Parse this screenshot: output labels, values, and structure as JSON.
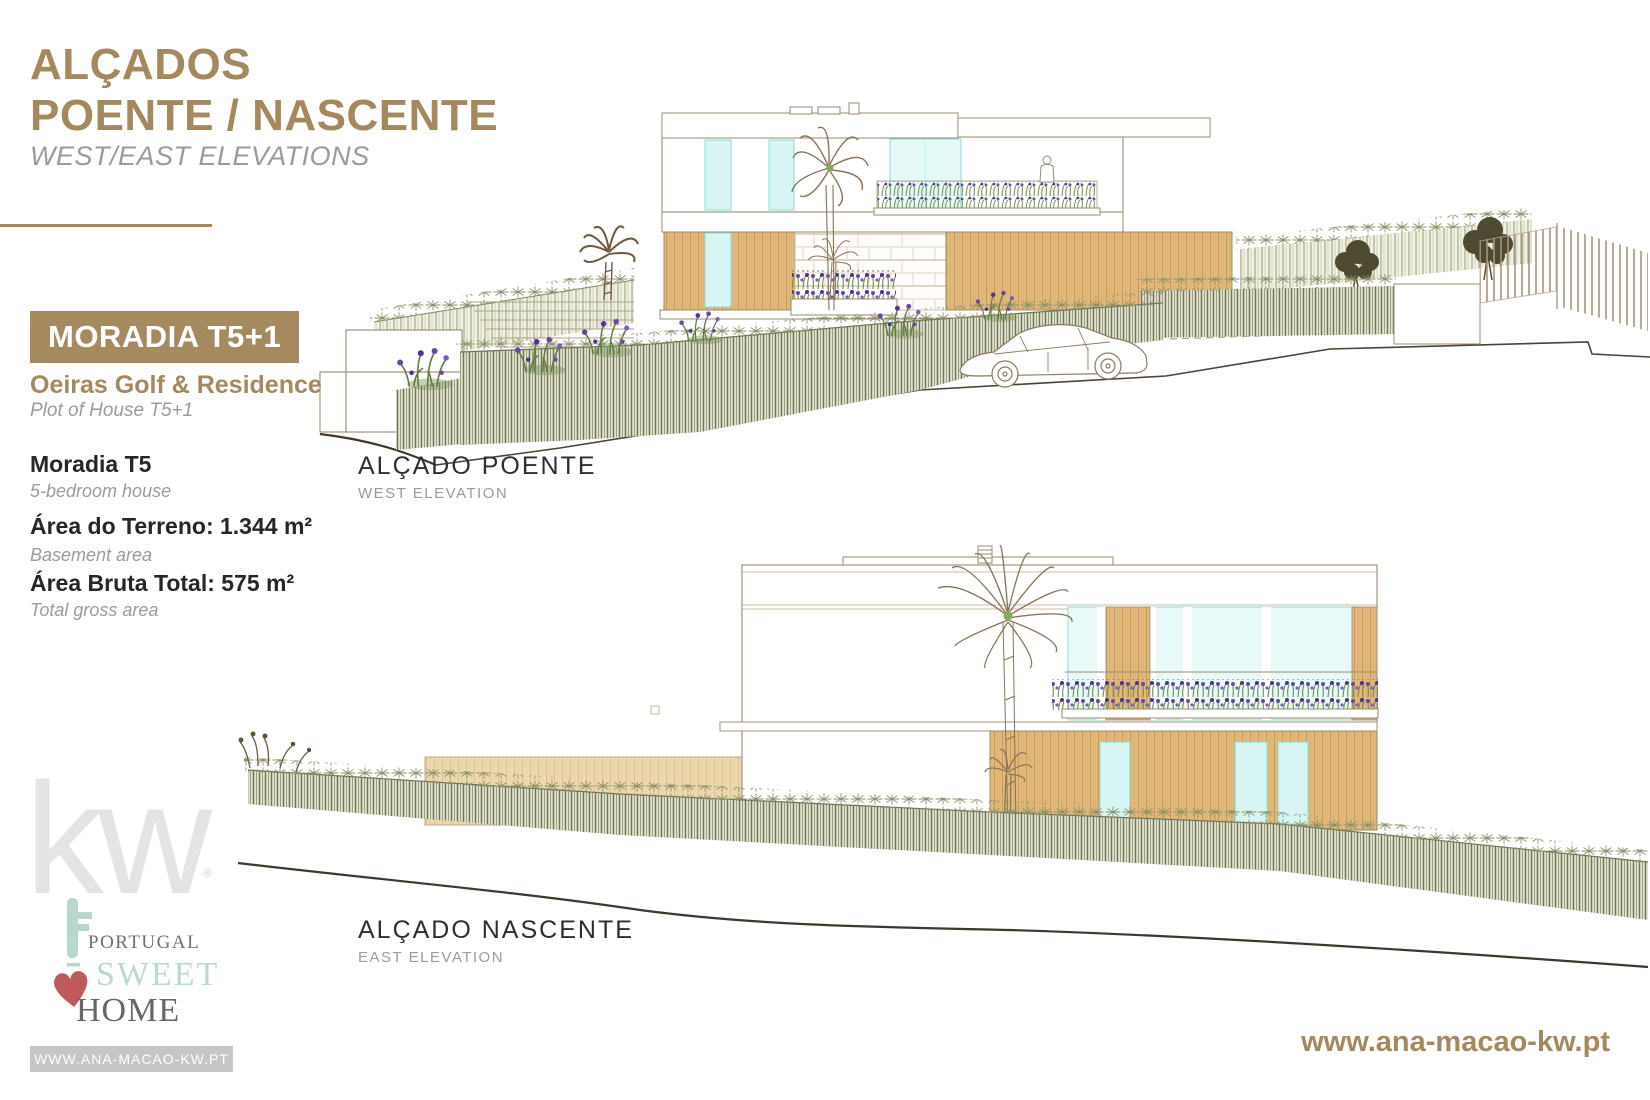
{
  "header": {
    "title_line1": "ALÇADOS",
    "title_line2": "POENTE / NASCENTE",
    "subtitle": "WEST/EAST ELEVATIONS"
  },
  "property": {
    "badge": "MORADIA T5+1",
    "development": "Oeiras Golf & Residence",
    "development_sub": "Plot of House T5+1",
    "details": [
      {
        "label": "Moradia T5",
        "sub": "5-bedroom house"
      },
      {
        "label": "Área do Terreno: 1.344 m²",
        "sub": "Basement area"
      },
      {
        "label": "Área Bruta Total: 575 m²",
        "sub": "Total gross area"
      }
    ]
  },
  "elevations": {
    "west": {
      "title": "ALÇADO POENTE",
      "subtitle": "WEST ELEVATION"
    },
    "east": {
      "title": "ALÇADO NASCENTE",
      "subtitle": "EAST ELEVATION"
    }
  },
  "branding": {
    "kw": "kw",
    "registered": "®",
    "psh_line1": "PORTUGAL",
    "psh_line2": "SWEET",
    "psh_line3": "HOME",
    "url_badge": "WWW.ANA-MACAO-KW.PT",
    "footer_url": "www.ana-macao-kw.pt"
  },
  "colors": {
    "accent_tan": "#a5895e",
    "text_dark": "#262626",
    "text_gray": "#9b9b9b",
    "wood": "#e1b97b",
    "glass": "#d7f5f2",
    "hedge": "#6f7456",
    "mint": "#bcd9d1",
    "heart_red": "#bf5a5c",
    "kw_gray": "#e4e4e4"
  }
}
